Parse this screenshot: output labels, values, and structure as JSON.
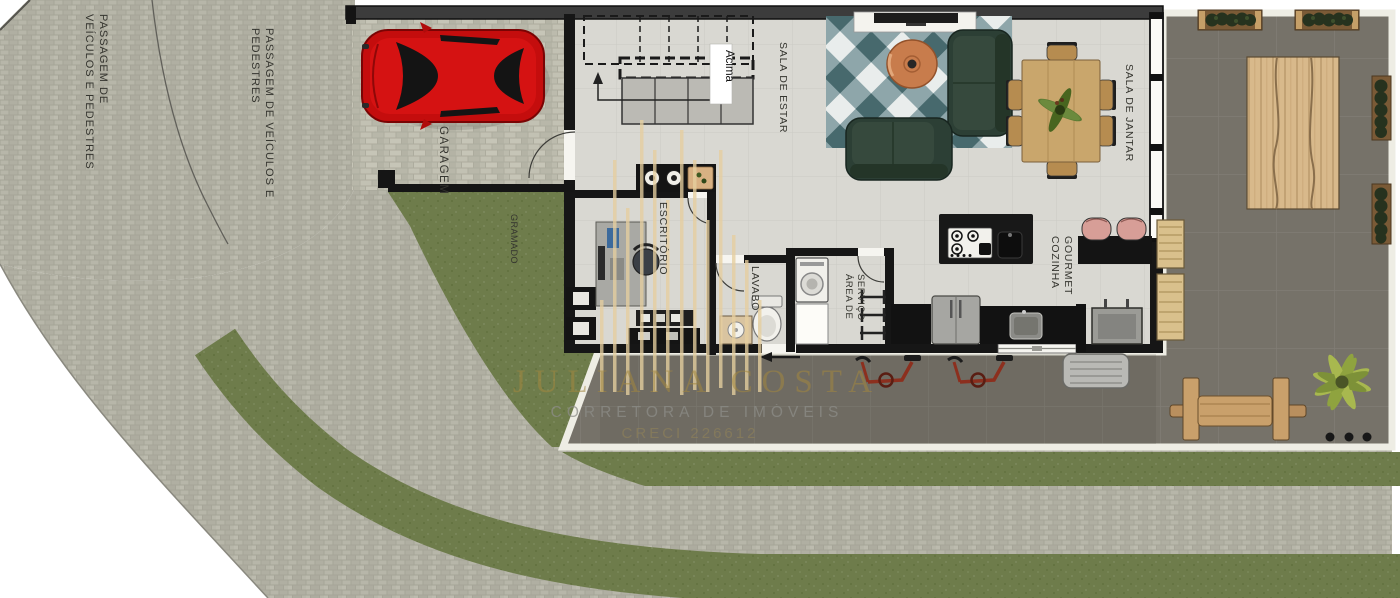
{
  "page": {
    "title": "Planta baixa térreo",
    "background": "#ffffff"
  },
  "watermark": {
    "line1": "JULIANA COSTA",
    "line2": "CORRETORA DE IMÓVEIS",
    "line3": "CRECI 226612",
    "gold": "#a3873f",
    "gray": "#8d8d88"
  },
  "areas": {
    "passage1_line1": "PASSAGEM DE",
    "passage1_line2": "VEÍCULOS E PEDESTRES",
    "passage2_line1": "PASSAGEM DE VEÍCULOS E",
    "passage2_line2": "PEDESTRES",
    "garage": "GARAGEM",
    "lawn": "GRAMADO",
    "stair_up": "Acima",
    "living": "SALA DE ESTAR",
    "dining": "SALA DE JANTAR",
    "kitchen_line1": "COZINHA",
    "kitchen_line2": "GOURMET",
    "office": "ESCRITÓRIO",
    "powder_room": "LAVABO",
    "service_line1": "ÁREA DE",
    "service_line2": "SERVIÇO"
  },
  "colors": {
    "road_paver": "#b0afa2",
    "grass": "#6e7c4b",
    "patio": "#767269",
    "house_floor": "#d9d8d2",
    "wall": "#161616",
    "car": "#c40d0d",
    "sofa": "#2c3f35",
    "coffee_table": "#c87c4c",
    "wood": "#c9a66c",
    "stool": "#d79e97"
  }
}
